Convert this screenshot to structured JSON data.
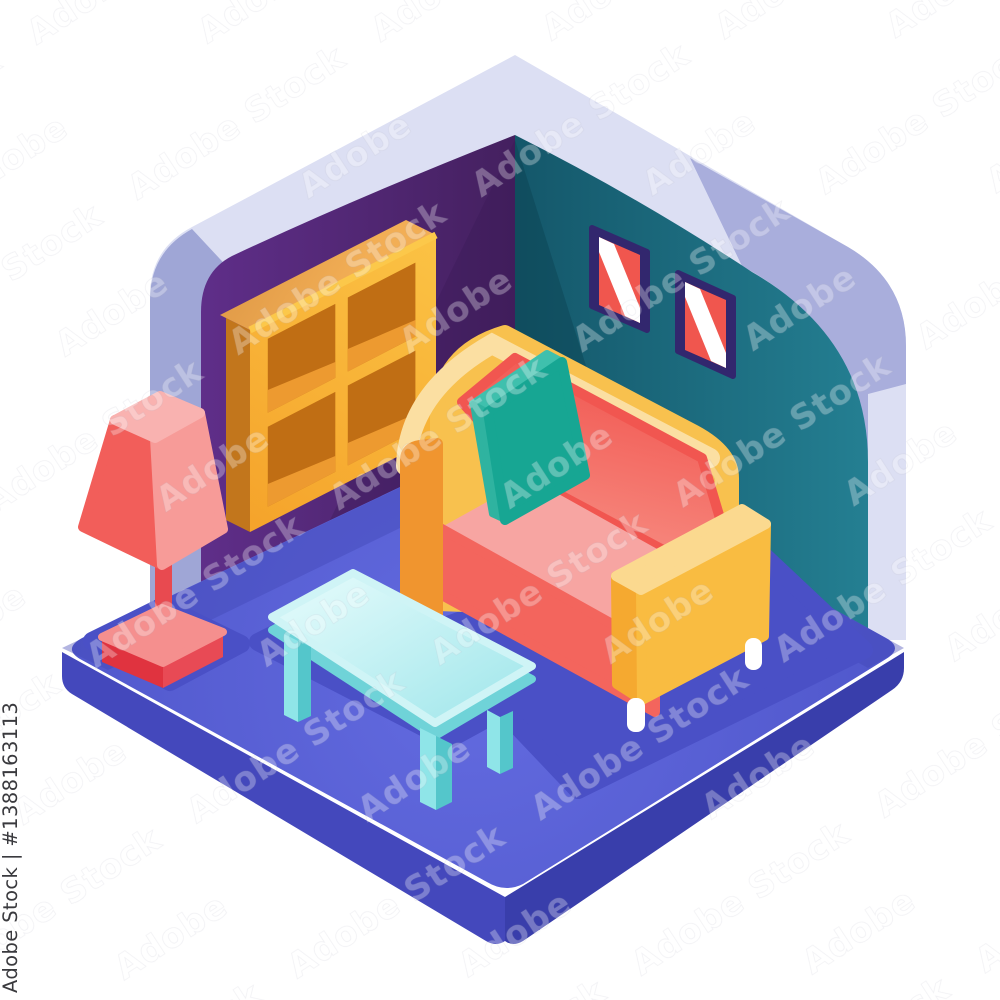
{
  "watermark": {
    "tile_text": "Adobe Stock",
    "id_label": "Adobe Stock | #1388163113"
  },
  "scene": {
    "title": "Isometric cutaway living room illustration",
    "objects": [
      {
        "name": "left-wall",
        "color": "#5E2E89"
      },
      {
        "name": "right-wall",
        "color": "#1E6F82"
      },
      {
        "name": "wall-shell",
        "color": "#DCDFF3"
      },
      {
        "name": "floor-platform",
        "color": "#5A62D6"
      },
      {
        "name": "bookshelf",
        "color": "#F8B93A"
      },
      {
        "name": "picture-frame-left",
        "frame_color": "#32276E",
        "fill_color": "#F0564E"
      },
      {
        "name": "picture-frame-right",
        "frame_color": "#32276E",
        "fill_color": "#F0564E"
      },
      {
        "name": "sofa",
        "frame_color": "#F8C14E",
        "cushion_color": "#F2635B",
        "seat_color": "#F7A5A2",
        "pillow_color": "#17A693",
        "leg_color": "#FFFFFF"
      },
      {
        "name": "coffee-table",
        "top_color": "#C9F3F5",
        "leg_color": "#8FE5E8"
      },
      {
        "name": "floor-lamp",
        "shade_color": "#F25E5A",
        "base_color": "#F58F8E"
      }
    ],
    "background_color": "#FFFFFF",
    "shadow_color": "#4A50C6"
  }
}
